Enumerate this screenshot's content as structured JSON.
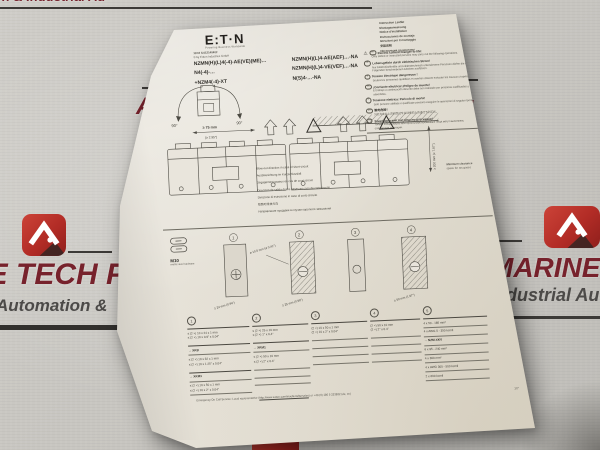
{
  "scene": {
    "bg_color": "#c9c7c2",
    "paper_color": "#e7e3da",
    "accent_red": "#a3242e",
    "maroon": "#77222c"
  },
  "watermark": {
    "top_fragment": "n & Industrial Au",
    "letter_a": "A",
    "top_right_letter": "D.",
    "top_right_small": "y",
    "left_title": "NE TECH PV",
    "left_subtitle": "Automation &",
    "right_title": "MARINE T",
    "right_subtitle": "Industrial Aut"
  },
  "paper": {
    "header": {
      "logo_text": "E:T·N",
      "tagline": "Powering Business Worldwide",
      "doc_number": "11/16 IL01214040Z",
      "copyright": "© by Eaton Industries GmbH",
      "languages": [
        "Instruction Leaflet",
        "Montageanweisung",
        "Notice d'installation",
        "Instrucciones de montaje",
        "Istruzioni per il montaggio",
        "安装说明",
        "Инструкция по монтажу"
      ]
    },
    "codes_left": [
      "NZMN(H)(L)4(-4)-AE(VE)(ME)…",
      "N4(-4)-…",
      "+NZM4(-4)-XT"
    ],
    "codes_right": [
      "NZMN(H)(L)4-AE(AEF)…-NA",
      "NZMN(H)(L)4-VE(VEF)…-NA",
      "N(S)4-…-NA"
    ],
    "warnings": [
      {
        "tag": "en",
        "title": "Electric current! Danger to life!",
        "body": "Only skilled or instructed persons may carry out the following operations."
      },
      {
        "tag": "de",
        "title": "Lebensgefahr durch elektrischen Strom!",
        "body": "Nur Elektrofachkräfte und elektrotechnisch unterwiesene Personen dürfen die im Folgenden beschriebenen Arbeiten ausführen."
      },
      {
        "tag": "fr",
        "title": "Tension électrique dangereuse !",
        "body": "Seules les personnes qualifiées et averties doivent exécuter les travaux ci-après."
      },
      {
        "tag": "es",
        "title": "¡Corriente eléctrica! ¡Peligro de muerte!",
        "body": "El trabajo a continuación descrito debe ser realizado por personas cualificadas y advertidas."
      },
      {
        "tag": "it",
        "title": "Tensione elettrica: Pericolo di morte!",
        "body": "Solo persone abilitate e qualificate possono eseguire le operazioni di seguito riportate."
      },
      {
        "tag": "zh",
        "title": "触电危险！",
        "body": "只允许专业人员和受过专业训练的人员进行下列工作。"
      },
      {
        "tag": "ru",
        "title": "Электрический ток! Опасно для жизни!",
        "body": "Только специалисты или проинструктированные лица могут выполнять следующие операции."
      }
    ],
    "fig_rotation": {
      "left_angle": "90°",
      "right_angle": "90°"
    },
    "fig_main": {
      "dim_top": "≥ 75 mm",
      "dim_top_in": "(≥ 2.95\")",
      "dim_side": "≥ 200 mm (≥ 7.87\")",
      "note1": "Minimum clearance",
      "note2": "space for arc gases"
    },
    "blowout": [
      "Blow-out direction in case of short-circuit",
      "Ausblasrichtung im Kurzschlussfall",
      "Dégagement gazeux en cas de court-circuit",
      "Dirección de salida de los gases en caso de cortocircuito",
      "Direzione di estrusione in caso di corto circuito",
      "短路时排放方向",
      "Направление продувки в случае короткого замыкания"
    ],
    "m10": {
      "label": "M10",
      "sub": "metric size hardware"
    },
    "busbar": {
      "n1": "1",
      "n2": "2",
      "n3": "3",
      "n4": "4",
      "d1": "≥ 24 mm (0.94\")",
      "d2": "≥ 25 mm (0.98\")",
      "d3": "⌀ 10.5 mm (⌀ 0.41\")",
      "d4": "≥ 50 mm (1.97\")"
    },
    "table": {
      "h": [
        "1",
        "2",
        "3",
        "4",
        "5"
      ],
      "col1": {
        "r1a": "≤ (2 ×) 10 x 24 x 1 mm",
        "r1b": "≤ (2 ×) 10 x 0.9\" x 0.04\"",
        "h2": "→ XKB",
        "r2a": "≤ (2 ×) 10 x 32 x 1 mm",
        "r2b": "≤ (2 ×) 10 x 1.25\" x 0.04\"",
        "h3": "→ XKM1",
        "r3a": "≤ (2 ×) 10 x 50 x 1 mm",
        "r3b": "≤ (2 ×) 10 x 2\" x 0.04\""
      },
      "col2": {
        "r1a": "≤ (2 ×) 25 x 10 mm",
        "r1b": "≤ (2 ×) 1\" x 0.4\"",
        "h2": "→ XKM1",
        "r2a": "≤ (2 ×) 50 x 10 mm",
        "r2b": "≤ (2 ×) 2\" x 0.4\""
      },
      "col3": {
        "r1a": "(2 ×) 10 x 50 x 1 mm",
        "r1b": "(2 ×) 10 x 2\" x 0.04\""
      },
      "col4": {
        "r1a": "(2 ×) 50 x 10 mm",
        "r1b": "(2 ×) 2\" x 0.4\""
      },
      "col5": {
        "rows": [
          "4 x 50 - 185 mm²",
          "4 x AWG 0 - 350 kcmil",
          "→ NZM-XKV",
          "6 x 95 - 240 mm²",
          "4 x 300 mm²",
          "4 x AWG 300 - 500 kcmil",
          "2 x 600 kcmil"
        ]
      }
    },
    "footer": {
      "prefix": "Emergency On Call Service: Local representative (",
      "link": "http://www.eaton.com/moeller/aftersales",
      "suffix": ") or +49 (0) 180 5 223822 (de, en)",
      "page": "1/7"
    }
  }
}
